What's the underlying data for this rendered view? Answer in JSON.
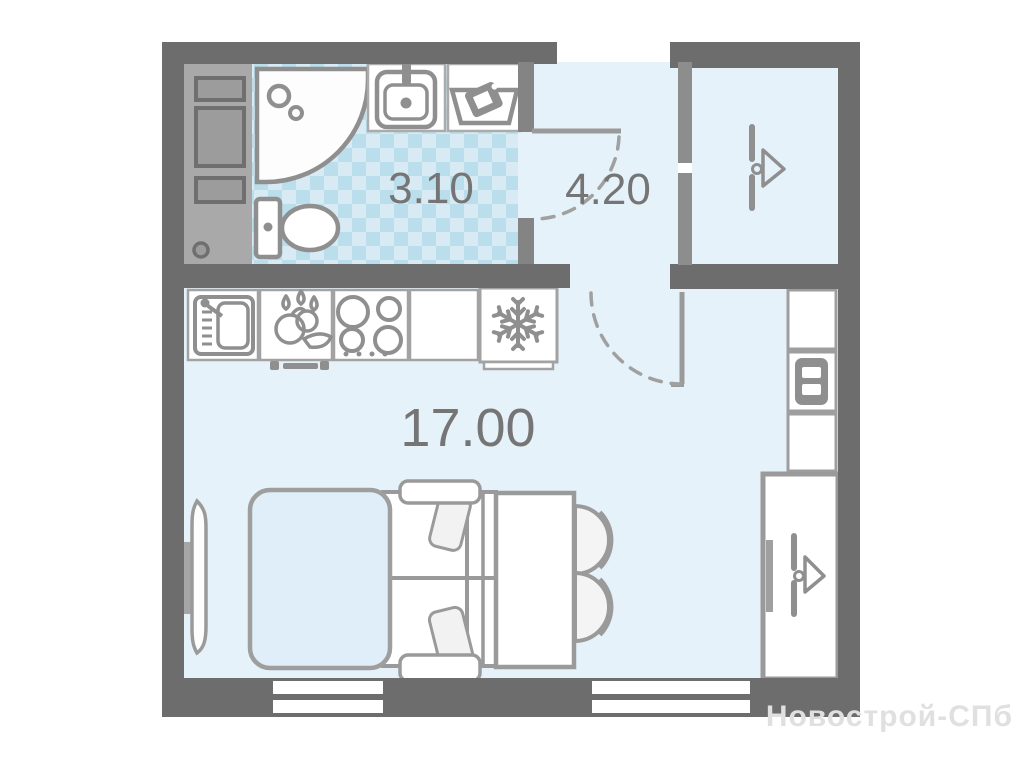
{
  "plan": {
    "rooms": [
      {
        "name": "bathroom",
        "area_label": "3.10"
      },
      {
        "name": "hallway",
        "area_label": "4.20"
      },
      {
        "name": "living-room",
        "area_label": "17.00"
      }
    ],
    "watermark": "Новострой-СПб",
    "fixtures": {
      "bathroom": [
        "utility-cabinet",
        "shower",
        "washbasin",
        "laundry-basket",
        "toilet"
      ],
      "kitchen": [
        "kitchen-sink",
        "food-prep",
        "cooktop",
        "counter",
        "fridge"
      ],
      "living_room": [
        "double-bed",
        "pillows",
        "bedside-bench",
        "dining-table",
        "chairs",
        "radiator"
      ],
      "storage": [
        "hanger-closet",
        "shelf-unit",
        "wardrobe"
      ]
    },
    "colors": {
      "wall": "#6d6d6d",
      "partition": "#868686",
      "room_fill": "#e6f2fa",
      "tile_base": "#d8ebf4",
      "tile_diamond": "#badeeb",
      "fixture_stroke": "#8f8f8f",
      "label_text": "#757575",
      "watermark_text": "#e0e0e0"
    }
  }
}
